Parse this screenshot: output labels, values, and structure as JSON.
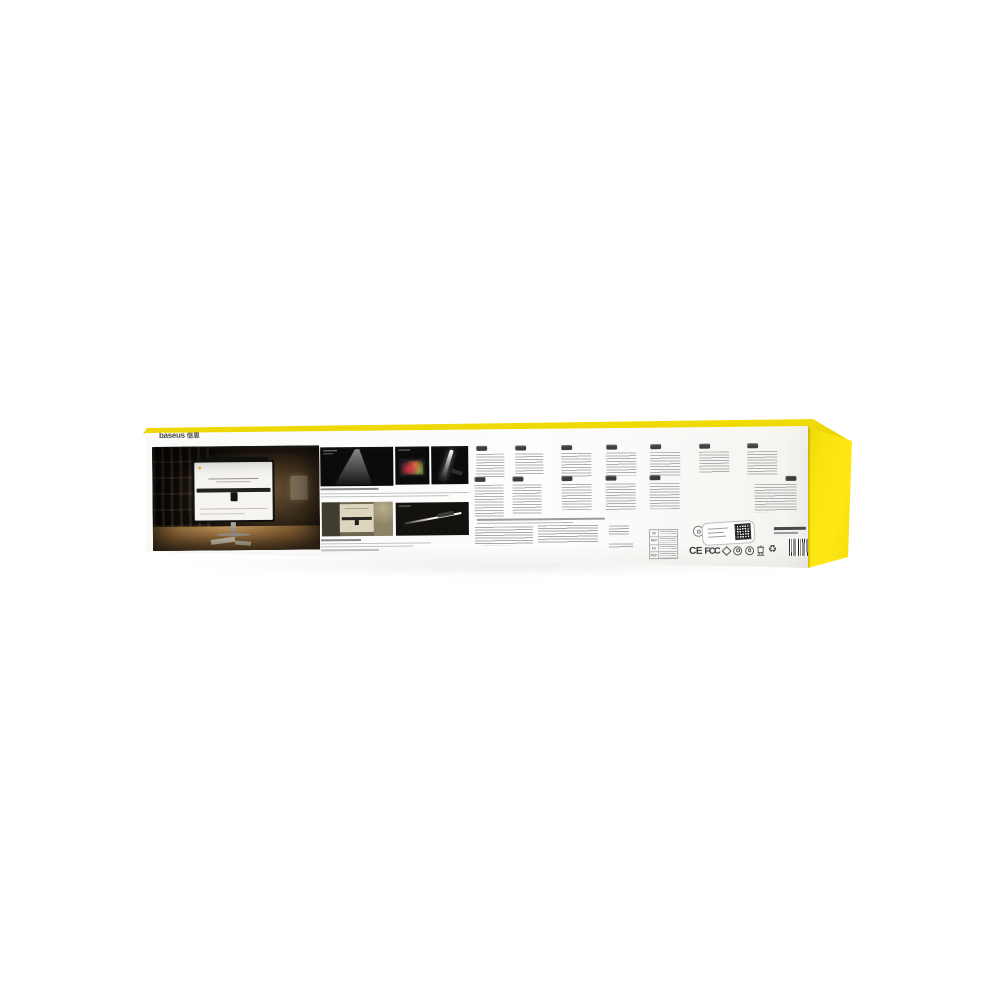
{
  "meta": {
    "description": "Back panel of a yellow Baseus monitor light bar retail box, photographed on a white background",
    "background_color": "#ffffff"
  },
  "brand": {
    "latin": "baseus",
    "cn": "倍思"
  },
  "colors": {
    "box_yellow_top": "#f0da05",
    "box_yellow_side": "#fbe511",
    "panel_white": "#fbfaf8",
    "micro_text_gray": "#b0b0b0",
    "badge_dark": "#3b3b3b"
  },
  "panel": {
    "hero_photo": "dark desk scene: monitor with light bar on top, bookshelf, warm lamp glow, papers on wooden desk",
    "gallery_photos": [
      "asymmetric light beam cone on black",
      "screen with colorful picture",
      "light bar with diagonal beam on black",
      "room scene, monitor silhouette with light bar",
      "light bar product diagonal on black"
    ],
    "language_columns": {
      "top_row": 7,
      "bottom_row": 5,
      "rtl_column": 1
    }
  },
  "legal": {
    "rep_table": {
      "rows": [
        {
          "code": "UK"
        },
        {
          "code": "REP"
        },
        {
          "code": "EU"
        },
        {
          "code": "REP"
        }
      ]
    },
    "certs": {
      "ce": "CE",
      "fcc": "FCC",
      "recycle": "♻"
    }
  }
}
